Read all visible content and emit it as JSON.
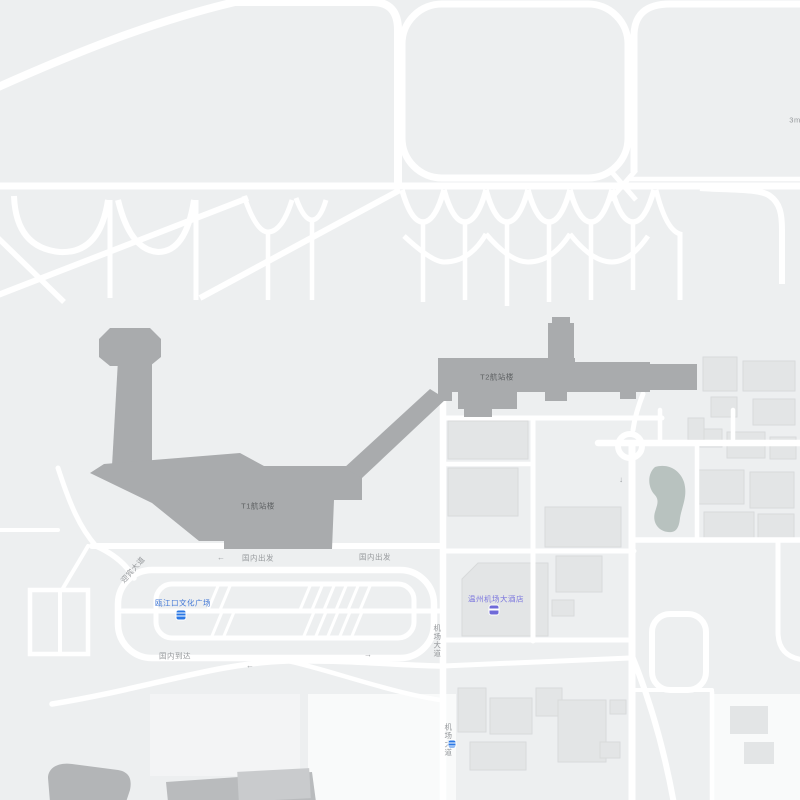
{
  "map": {
    "colors": {
      "background": "#edeff0",
      "road": "#ffffff",
      "terminal": "#a9abad",
      "terminal_label": "#5e6163",
      "building": "#e3e5e6",
      "building_border": "#d8dadb",
      "pond": "#b8c2bf",
      "road_label": "#95989b",
      "station_blue": "#3f76d6",
      "hotel_purple": "#7b76de",
      "dark_area": "#b4b6b8"
    },
    "terminals": [
      {
        "label": "T1航站楼"
      },
      {
        "label": "T2航站楼"
      }
    ],
    "road_labels": [
      {
        "text": "国内出发"
      },
      {
        "text": "国内出发"
      },
      {
        "text": "国内到达"
      },
      {
        "text": "迎宾大道"
      },
      {
        "text": "机场大道"
      },
      {
        "text": "机场大道"
      }
    ],
    "pois": [
      {
        "type": "transit-station",
        "label": "瓯江口文化广场"
      },
      {
        "type": "hotel",
        "label": "温州机场大酒店"
      }
    ],
    "corner_note": "3m",
    "arrows": [
      {
        "glyph": "←"
      },
      {
        "glyph": "←"
      },
      {
        "glyph": "→"
      },
      {
        "glyph": "↓"
      }
    ]
  }
}
